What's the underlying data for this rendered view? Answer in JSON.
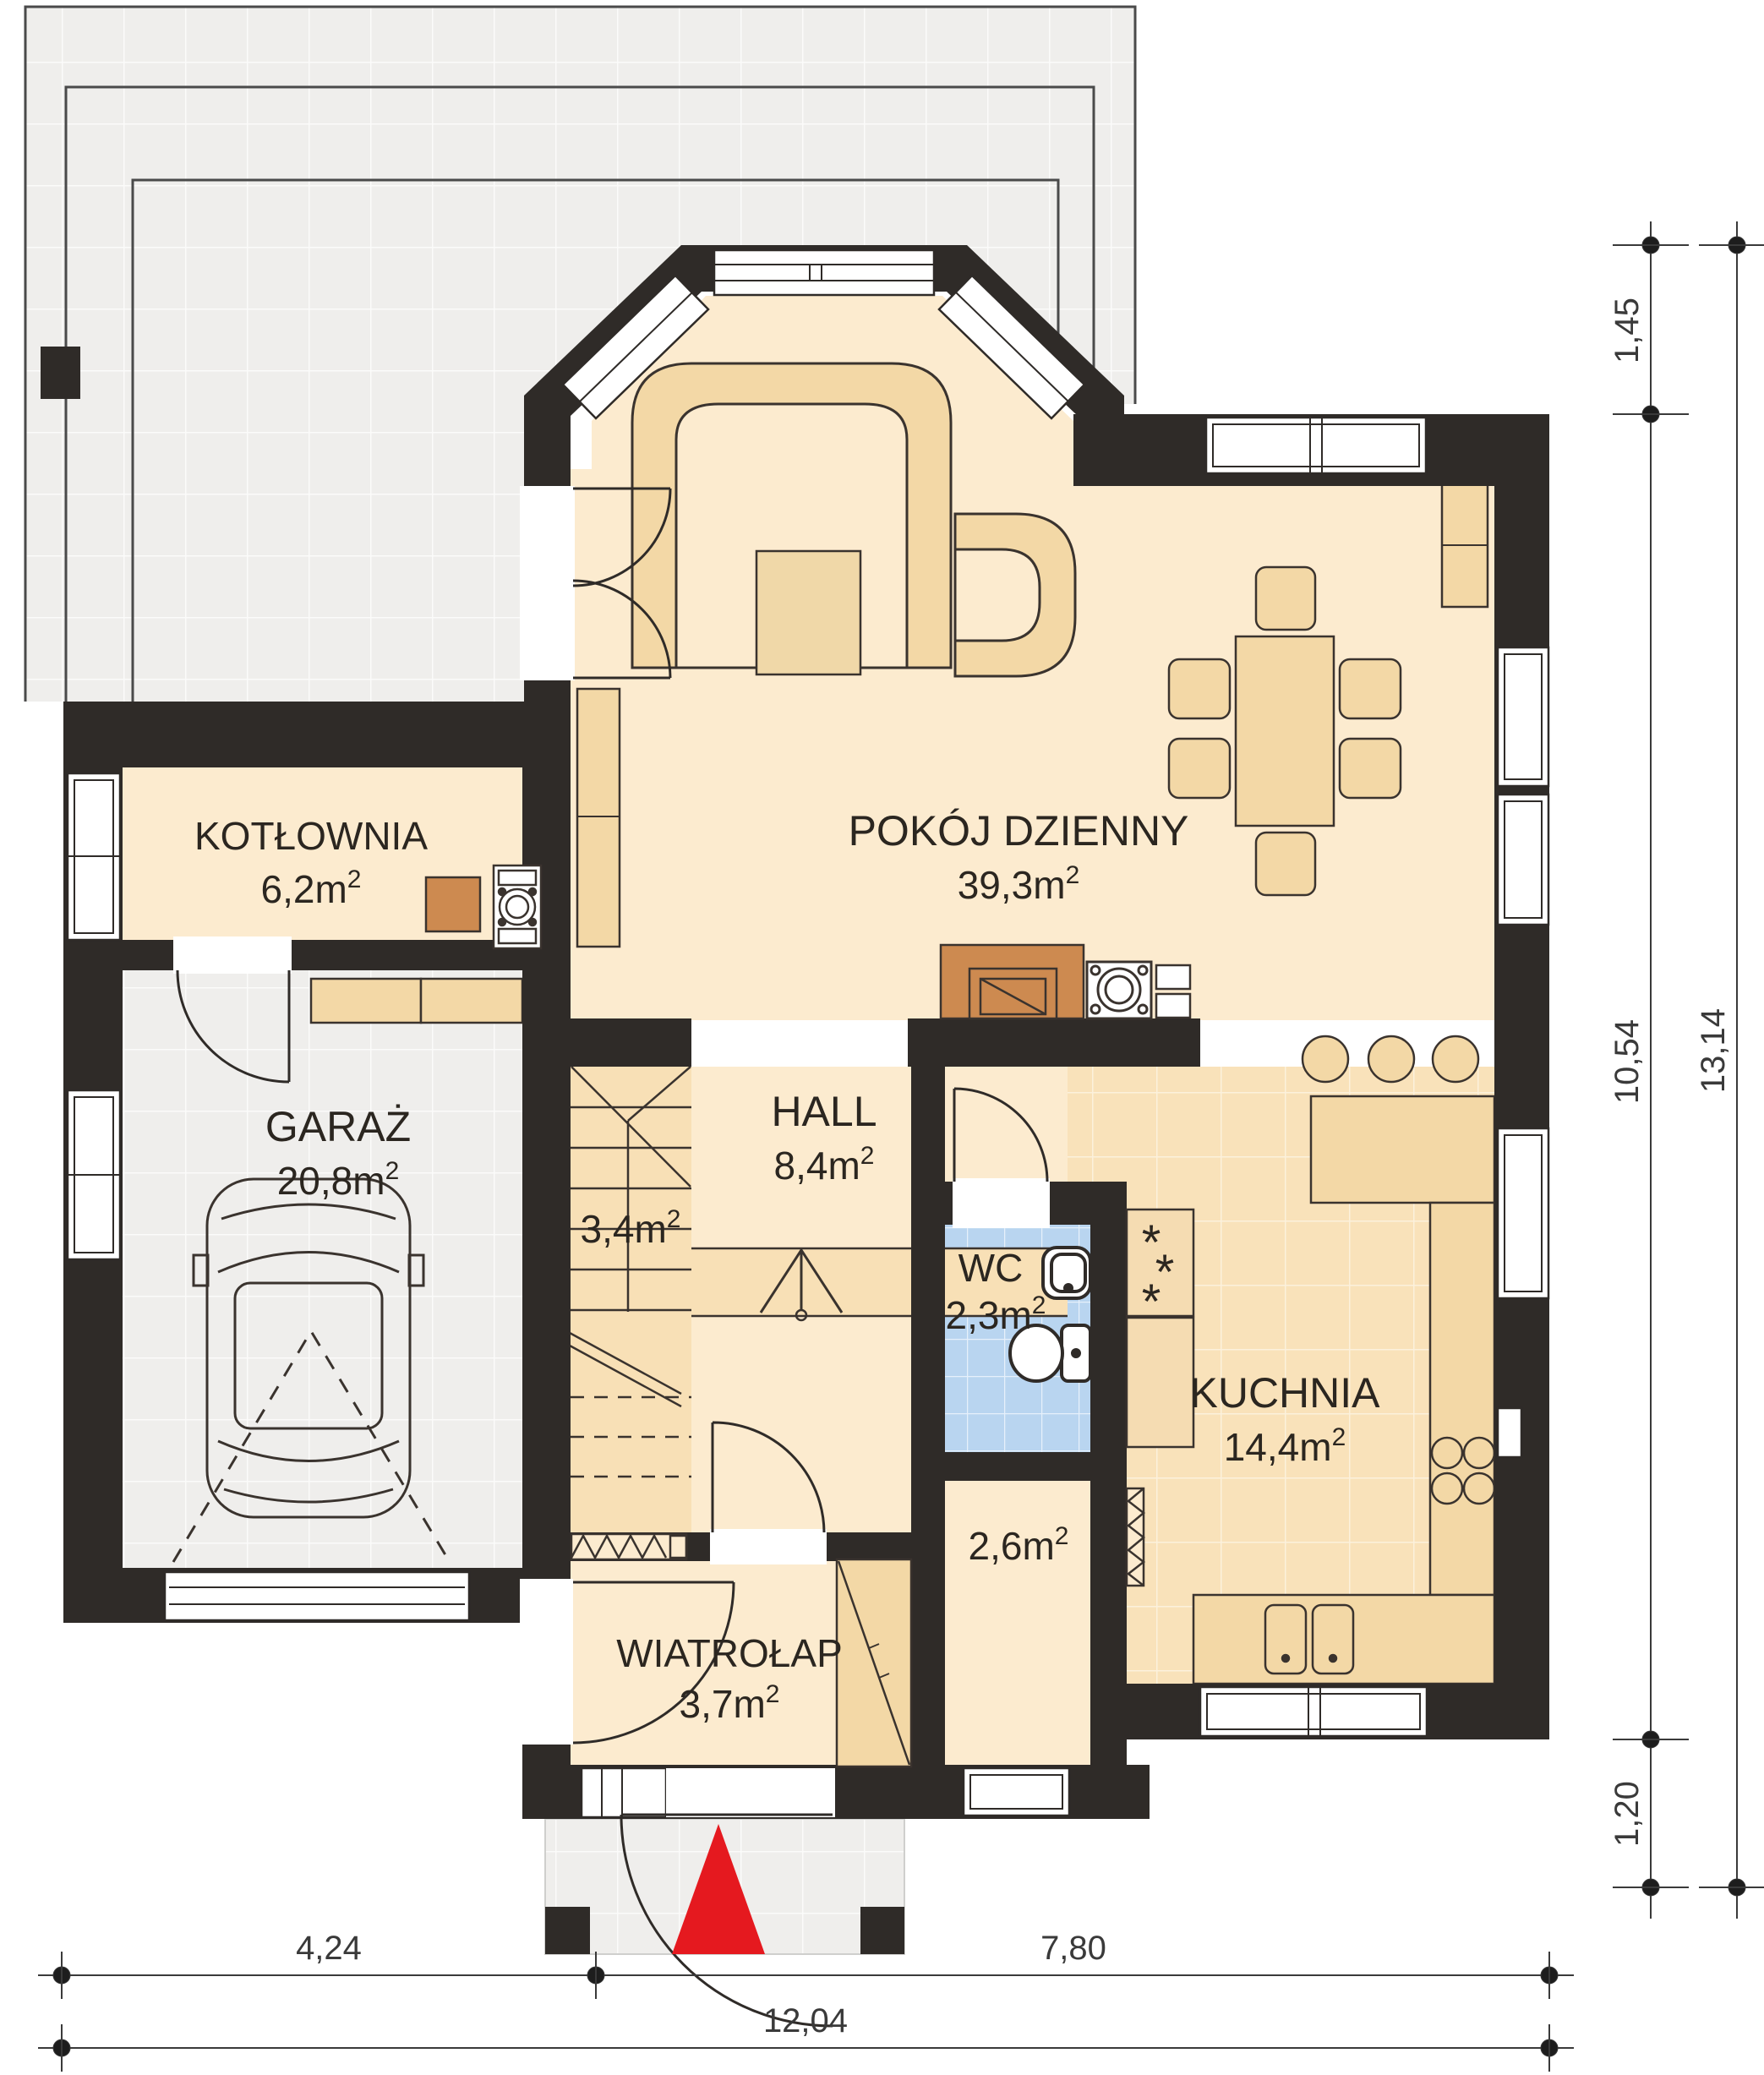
{
  "rooms": {
    "pokoj": {
      "name": "POKÓJ DZIENNY",
      "area": "39,3m"
    },
    "kotlownia": {
      "name": "KOTŁOWNIA",
      "area": "6,2m"
    },
    "garaz": {
      "name": "GARAŻ",
      "area": "20,8m"
    },
    "hall": {
      "name": "HALL",
      "area": "8,4m"
    },
    "schody": {
      "area": "3,4m"
    },
    "wc": {
      "name": "WC",
      "area": "2,3m"
    },
    "kuchnia": {
      "name": "KUCHNIA",
      "area": "14,4m"
    },
    "spizarnia": {
      "area": "2,6m"
    },
    "wiatrolap": {
      "name": "WIATROŁAP",
      "area": "3,7m"
    }
  },
  "units": {
    "sup": "2"
  },
  "dimensions": {
    "right": [
      "1,45",
      "10,54",
      "1,20",
      "13,14"
    ],
    "bottom": [
      "4,24",
      "7,80",
      "12,04"
    ]
  },
  "symbols": {
    "freezer_star": "*"
  },
  "colors": {
    "wall": "#2f2b28",
    "floor_cream": "#fcebcf",
    "furniture_beige": "#f3d8a6",
    "stairs_beige": "#f8e0b6",
    "kitchen_tile": "#f9e2ba",
    "wc_tile": "#b9d5f0",
    "paving_gray": "#efeeec",
    "fireplace_brown": "#cd8a50",
    "entry_arrow_red": "#e5191f",
    "line": "#3a332e"
  }
}
